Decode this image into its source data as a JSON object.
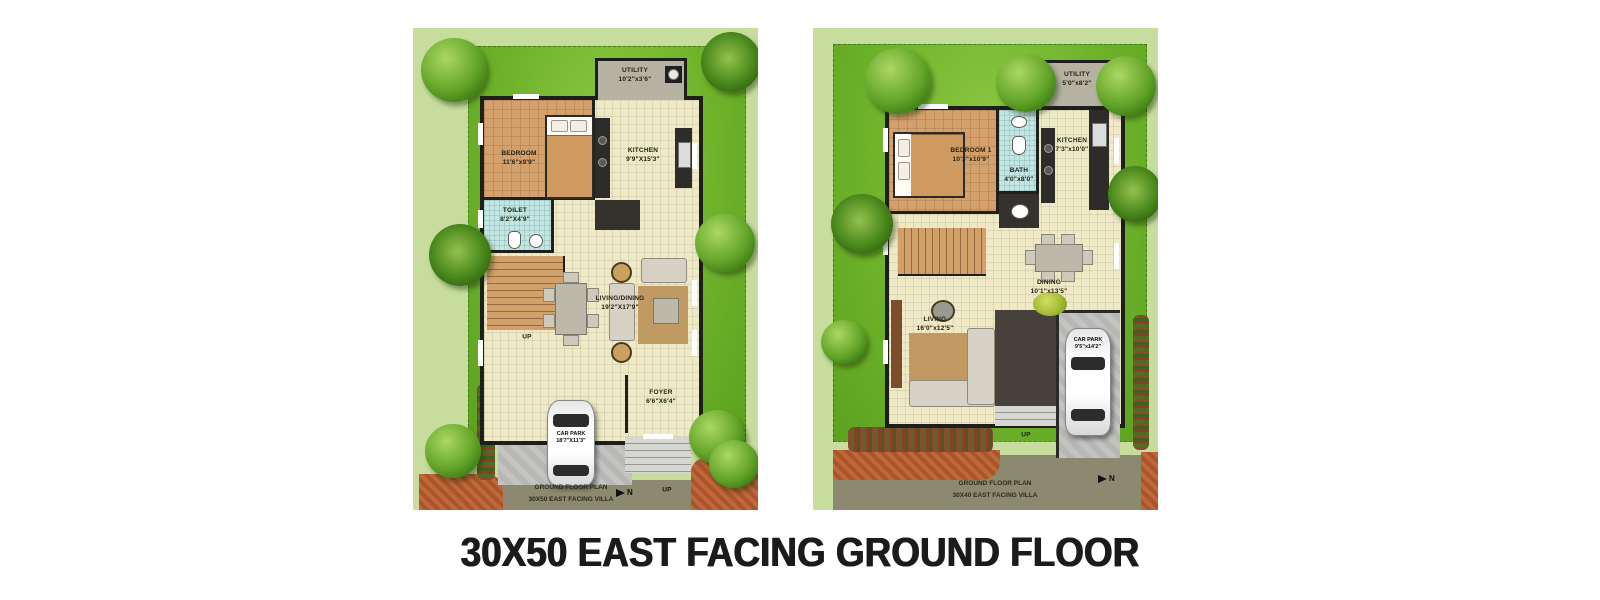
{
  "title": "30X50 EAST FACING GROUND FLOOR",
  "colors": {
    "lawn_green": "#6fb32b",
    "margin_green": "#c6dd9e",
    "wall_black": "#1e1e1c",
    "floor_cream": "#efe9c6",
    "floor_tan": "#d4a06b",
    "bath_blue": "#c2e6e2",
    "utility_grey": "#b5b2a4",
    "road_olive": "#8b8970",
    "driveway_grey": "#bdbdbb",
    "planter_orange": "#bc5f33",
    "title_black": "#1b1b1b"
  },
  "left_plan": {
    "caption": {
      "line1": "GROUND FLOOR PLAN",
      "line2": "30X50 EAST FACING VILLA"
    },
    "north_label": "N",
    "stairs_up_label": "UP",
    "porch_up_label": "UP",
    "rooms": {
      "utility": {
        "name": "UTILITY",
        "dims": "10'2\"x3'6\""
      },
      "bedroom": {
        "name": "BEDROOM",
        "dims": "11'6\"x9'9\""
      },
      "kitchen": {
        "name": "KITCHEN",
        "dims": "9'9\"X15'3\""
      },
      "toilet": {
        "name": "TOILET",
        "dims": "8'2\"X4'9\""
      },
      "living_dining": {
        "name": "LIVING/DINING",
        "dims": "19'2\"X17'9\""
      },
      "foyer": {
        "name": "FOYER",
        "dims": "6'6\"X6'4\""
      },
      "car_park": {
        "name": "CAR PARK",
        "dims": "18'7\"X11'3\""
      }
    }
  },
  "right_plan": {
    "caption": {
      "line1": "GROUND FLOOR PLAN",
      "line2": "30X40 EAST FACING VILLA"
    },
    "north_label": "N",
    "porch_up_label": "UP",
    "rooms": {
      "utility": {
        "name": "UTILITY",
        "dims": "5'0\"x8'2\""
      },
      "bedroom1": {
        "name": "BEDROOM 1",
        "dims": "10'3\"x10'9\""
      },
      "bath": {
        "name": "BATH",
        "dims": "4'0\"x8'0\""
      },
      "kitchen": {
        "name": "KITCHEN",
        "dims": "7'3\"x10'0\""
      },
      "dining": {
        "name": "DINING",
        "dims": "10'1\"x13'5\""
      },
      "living": {
        "name": "LIVING",
        "dims": "16'0\"x12'5\""
      },
      "car_park": {
        "name": "CAR PARK",
        "dims": "9'5\"x14'2\""
      }
    }
  }
}
